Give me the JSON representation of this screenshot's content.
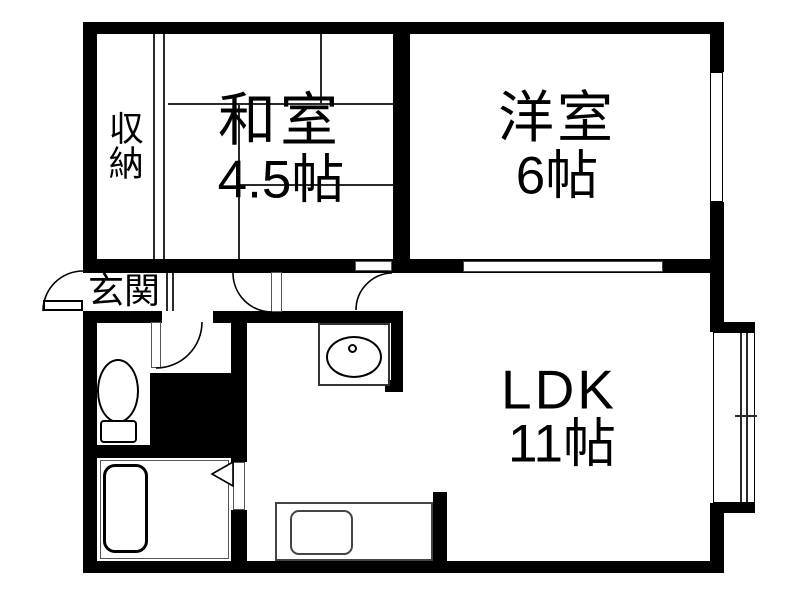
{
  "title": "apartment-floor-plan",
  "rooms": {
    "washitsu": {
      "name": "和室",
      "size": "4.5帖"
    },
    "yoshitsu": {
      "name": "洋室",
      "size": "6帖"
    },
    "ldk": {
      "name": "LDK",
      "size": "11帖"
    },
    "closet": {
      "name": "収納"
    },
    "genkan": {
      "name": "玄関"
    }
  },
  "fixtures": [
    "toilet",
    "toilet-tank",
    "bathtub",
    "washbasin",
    "washbasin-faucet",
    "kitchen-counter",
    "kitchen-sink",
    "pipe-space"
  ],
  "doors": [
    "entrance-door-swing",
    "hall-door-swing",
    "washitsu-door-swing",
    "toilet-door-swing",
    "bathroom-folding-door"
  ],
  "windows": [
    "yoshitsu-side-window",
    "yoshitsu-ldk-sliding-opening",
    "ldk-balcony-window"
  ],
  "colors": {
    "wall": "#000000",
    "background": "#ffffff",
    "line": "#2a2a2a"
  }
}
